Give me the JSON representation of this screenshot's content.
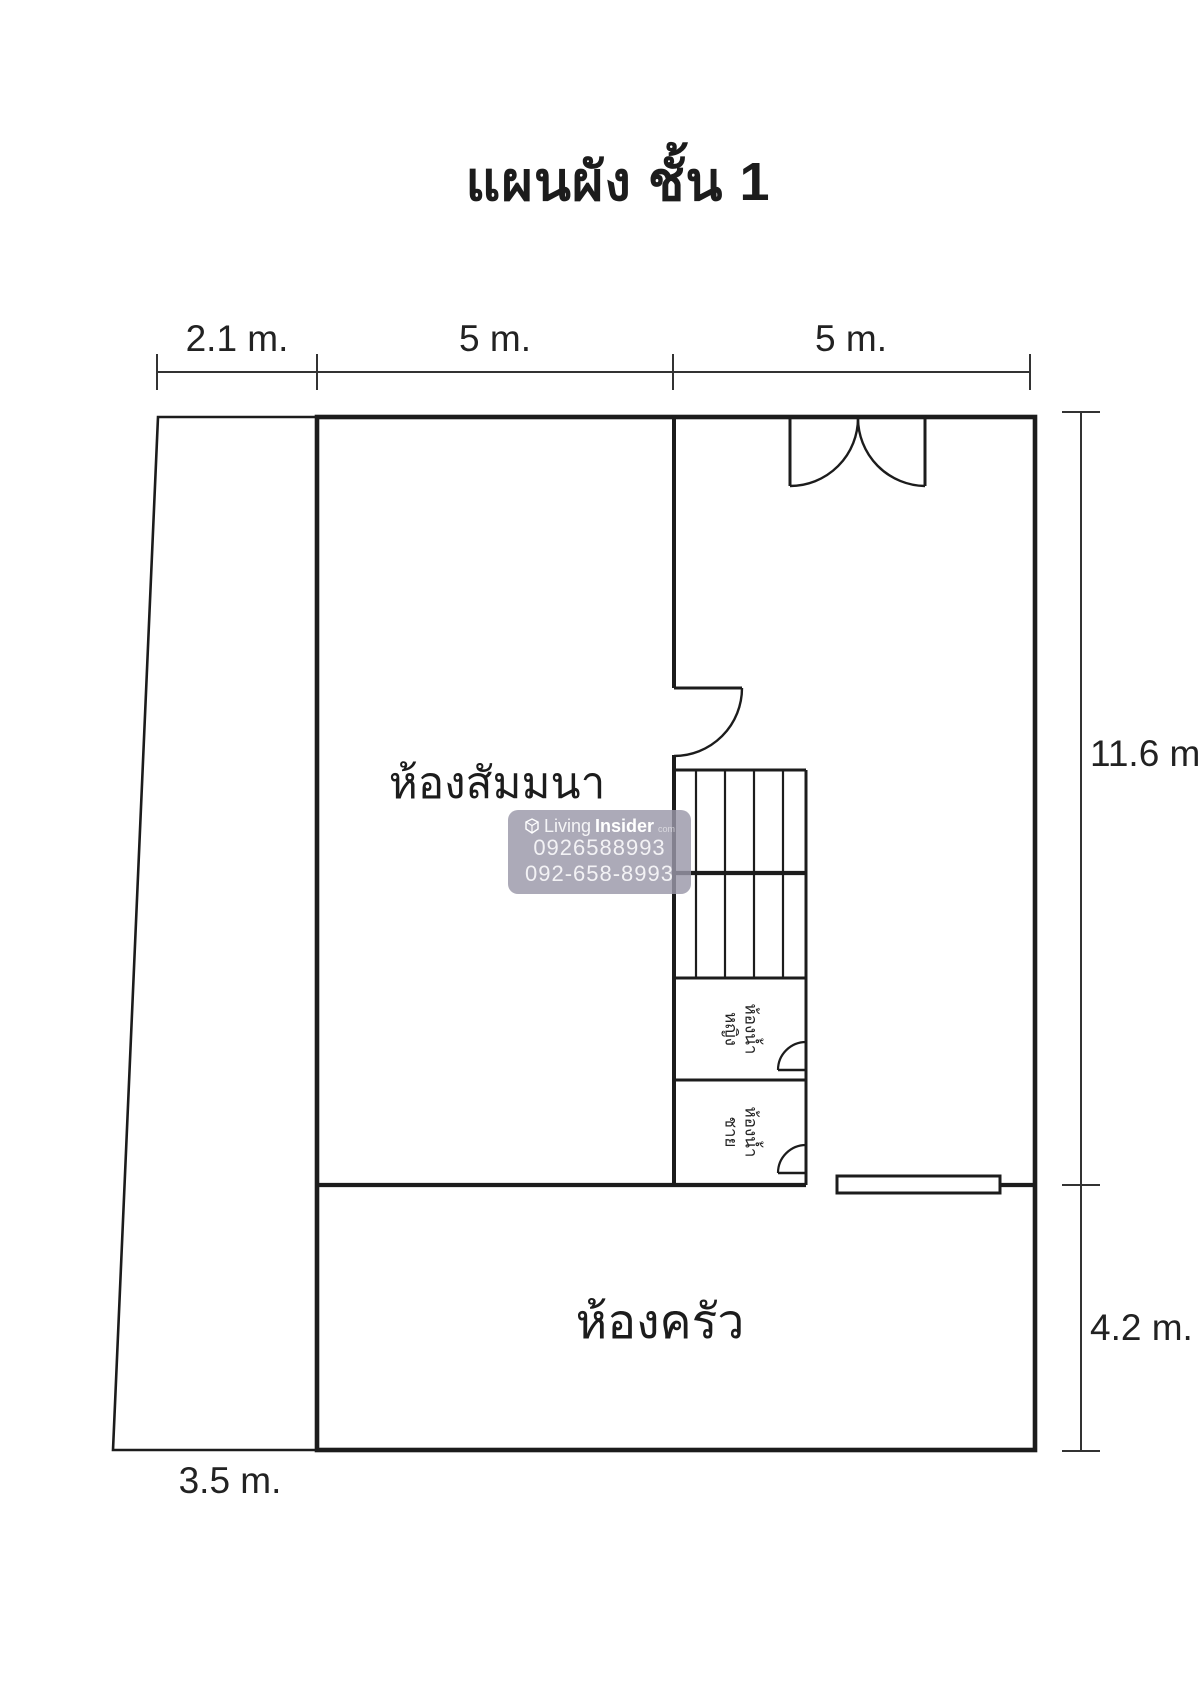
{
  "title": "แผนผัง ชั้น 1",
  "colors": {
    "background": "#ffffff",
    "wall_line": "#1c1c1c",
    "dimension_line": "#333333",
    "watermark_bg": "#9a97a8",
    "watermark_text": "#ffffff"
  },
  "dimensions": {
    "top": [
      {
        "label": "2.1 m."
      },
      {
        "label": "5 m."
      },
      {
        "label": "5 m."
      }
    ],
    "right": [
      {
        "label": "11.6 m."
      },
      {
        "label": "4.2 m."
      }
    ],
    "bottom_left": {
      "label": "3.5 m."
    }
  },
  "rooms": {
    "seminar": {
      "label": "ห้องสัมมนา"
    },
    "kitchen": {
      "label": "ห้องครัว"
    },
    "bathroom_women": {
      "label": "ห้องน้ำ\nหญิง"
    },
    "bathroom_men": {
      "label": "ห้องน้ำ\nชาย"
    }
  },
  "watermark": {
    "logo_icon": "livinginsider-cube-icon",
    "brand_living": "Living",
    "brand_insider": "Insider",
    "brand_tld": "com",
    "phone1": "0926588993",
    "phone2": "092-658-8993"
  }
}
